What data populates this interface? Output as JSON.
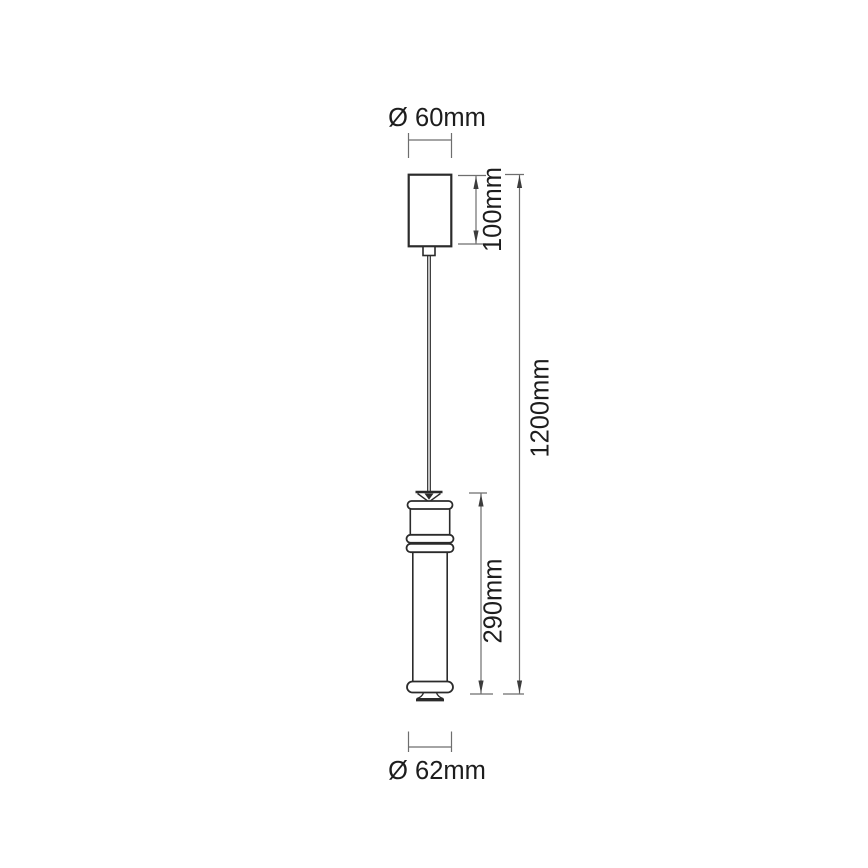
{
  "dimensions": {
    "canopy_diameter": "Ø 60mm",
    "canopy_height": "100mm",
    "overall_height": "1200mm",
    "body_height": "290mm",
    "body_diameter": "Ø 62mm"
  },
  "colors": {
    "background": "#ffffff",
    "outline": "#2b2b2b",
    "dimension": "#6e6e6e",
    "arrow": "#3c3c3c",
    "text": "#1d1d1d"
  }
}
